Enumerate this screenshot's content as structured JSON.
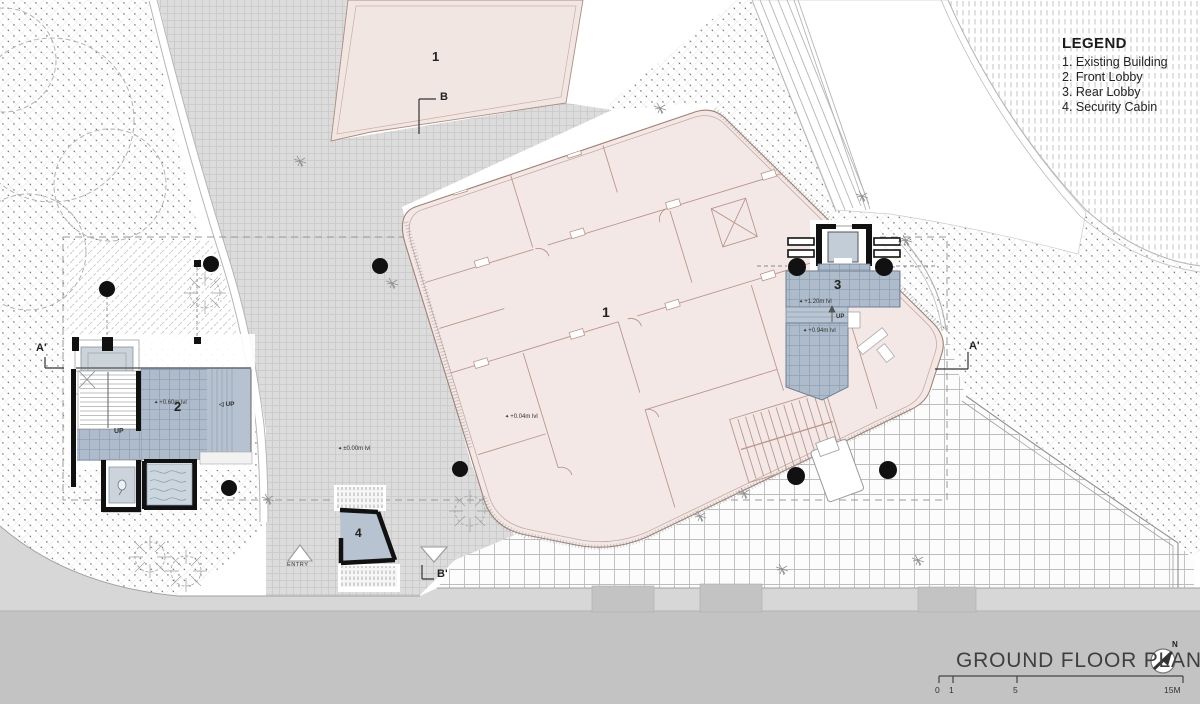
{
  "legend": {
    "title": "LEGEND",
    "items": [
      "1. Existing Building",
      "2. Front Lobby",
      "3. Rear Lobby",
      "4. Security Cabin"
    ]
  },
  "title_block": {
    "title": "GROUND FLOOR PLAN",
    "north_label": "N"
  },
  "scale_bar": {
    "ticks": [
      "0",
      "1",
      "5",
      "15M"
    ]
  },
  "rooms": {
    "existing_building_top": "1",
    "existing_building": "1",
    "front_lobby": "2",
    "rear_lobby": "3",
    "security_cabin": "4"
  },
  "levels": {
    "front_lobby": "+0.60m lvl",
    "plaza": "±0.00m lvl",
    "building": "+0.04m lvl",
    "rear_lobby_upper": "+1.20m lvl",
    "rear_lobby_lower": "+0.94m lvl"
  },
  "annotations": {
    "entry": "ENTRY",
    "up_front_lobby": "UP",
    "up_ramp": "UP",
    "up_rear_lobby": "UP"
  },
  "section_markers": {
    "b": "B",
    "b_prime": "B'",
    "a_prime_left": "A'",
    "a_prime_right": "A'"
  },
  "icons": {
    "level_marker": "✦",
    "ramp_arrow": "◁"
  },
  "colors": {
    "building_fill": "#f3e8e6",
    "building_line": "#9e8076",
    "lobby_fill": "#aebbca",
    "plaza_fill": "#dcdcdc",
    "sidewalk": "#d7d7d7",
    "road": "#c3c3c3",
    "wall_black": "#111111"
  }
}
